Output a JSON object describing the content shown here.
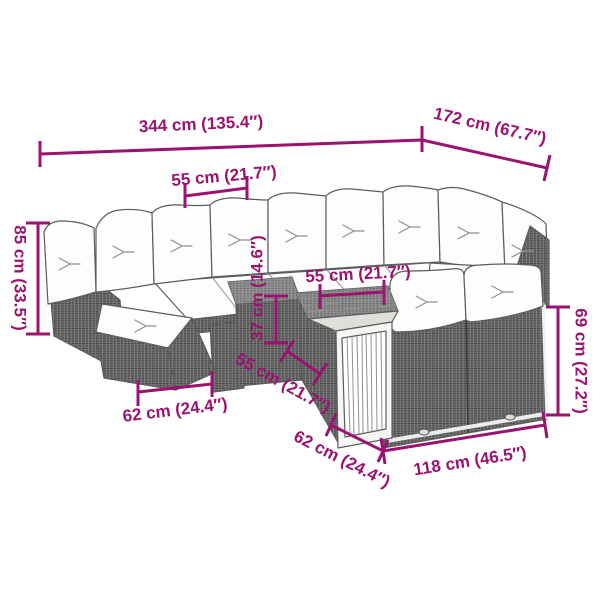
{
  "figure": {
    "description": "Isometric line drawing of a poly rattan garden lounge set with white cushions, footstool, rattan coffee table and slatted wooden table, annotated with product dimensions."
  },
  "colors": {
    "accent_magenta": "#9B1370",
    "outline_gray": "#5c5c5c",
    "rattan_gray": "#686868",
    "cushion_white": "#FDFDFD",
    "background": "#FFFFFF"
  },
  "labels": {
    "total_width": "344 cm (135.4″)",
    "total_depth": "172 cm (67.7″)",
    "back_seat_width": "55 cm (21.7″)",
    "total_height": "85 cm (33.5″)",
    "table_top_width": "55 cm (21.7″)",
    "table_height": "37 cm (14.6″)",
    "table_depth": "55 cm (21.7″)",
    "footstool_width": "62 cm (24.4″)",
    "table_front_width": "62 cm (24.4″)",
    "right_section_width": "118 cm (46.5″)",
    "right_side_height": "69 cm (27.2″)"
  }
}
